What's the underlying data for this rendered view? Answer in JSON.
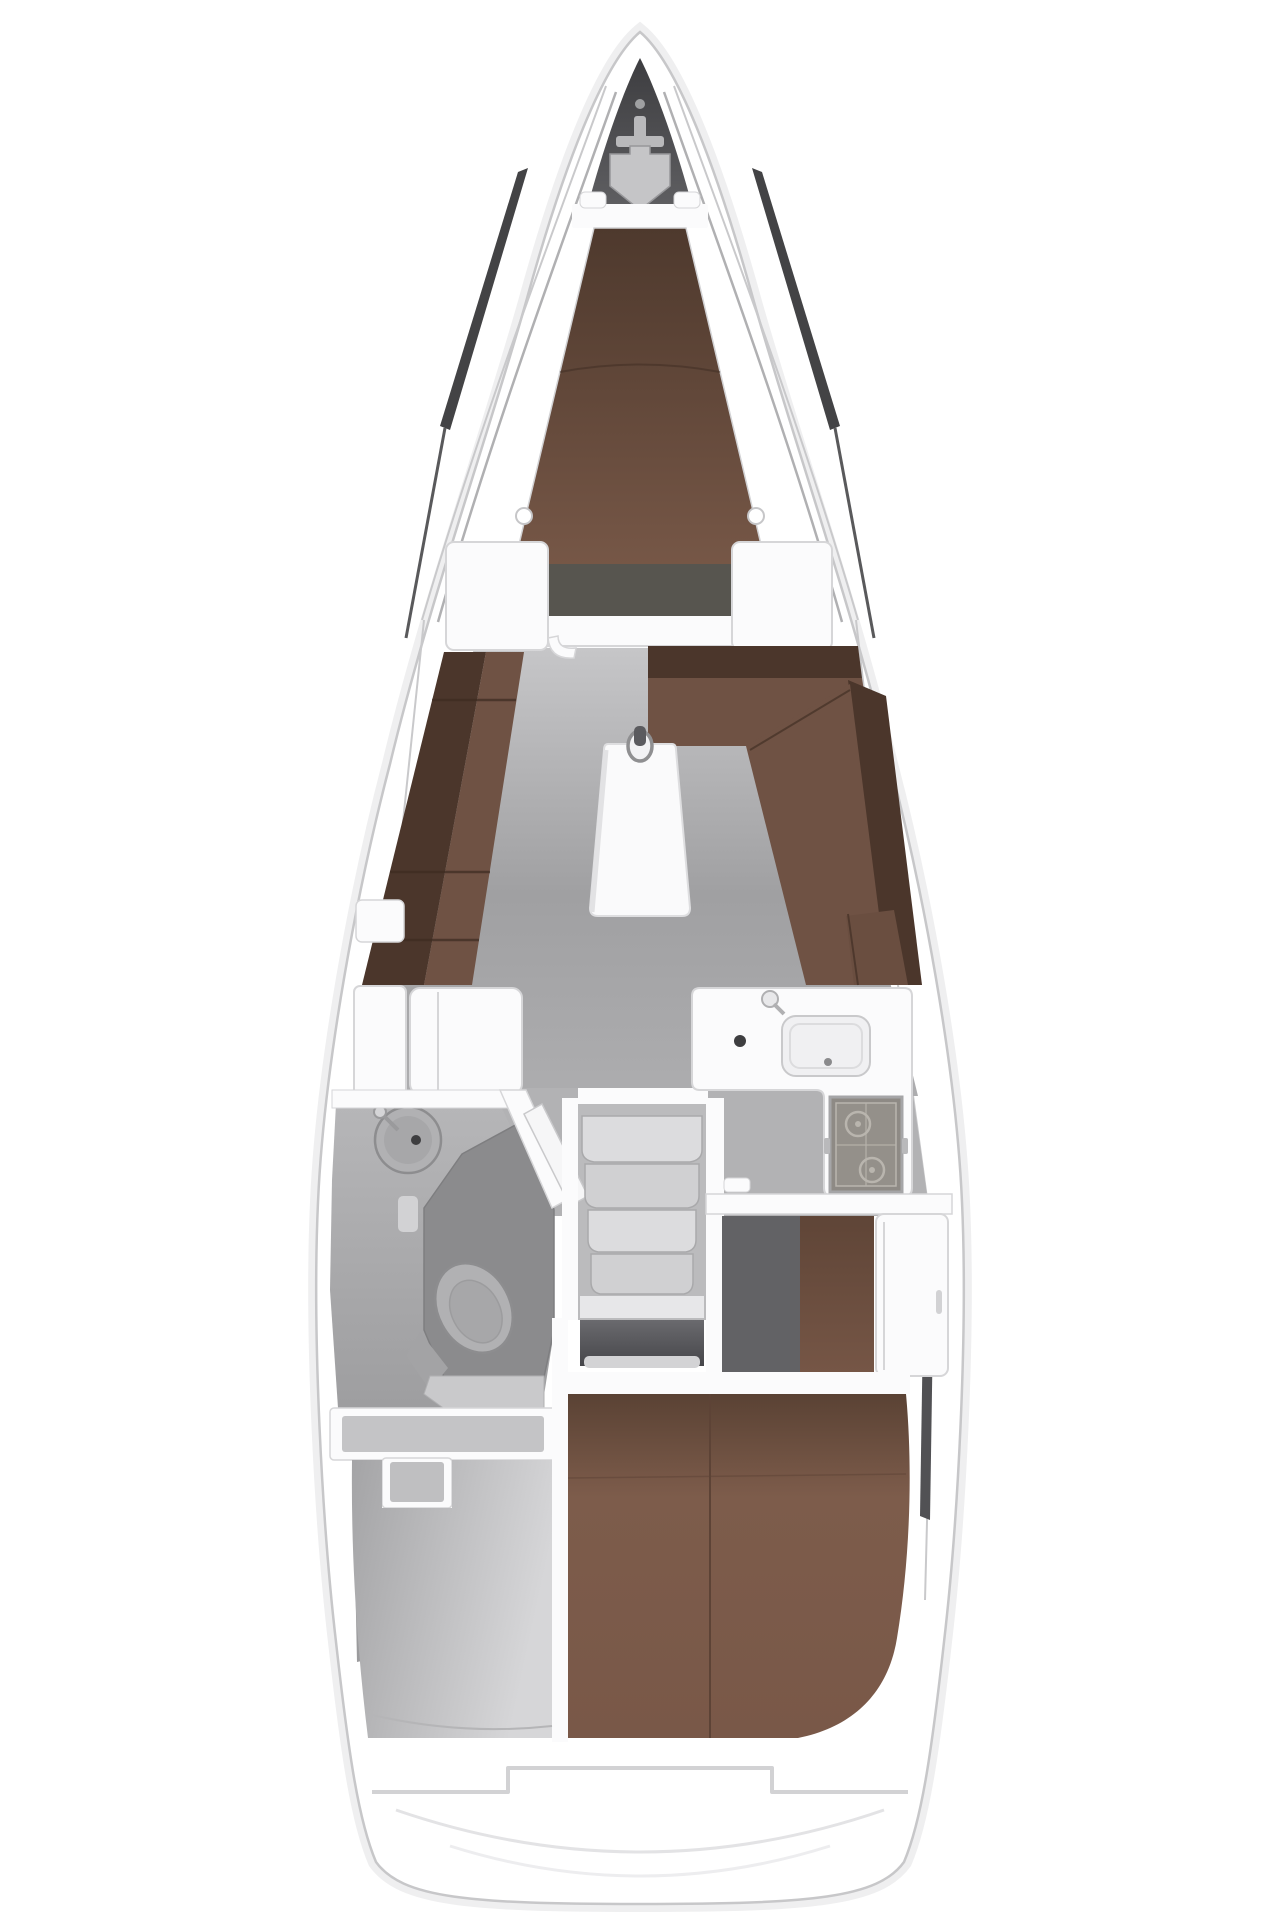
{
  "figure": {
    "type": "yacht-interior-floorplan",
    "orientation": "bow-up",
    "visible_text": ""
  },
  "regions": [
    {
      "id": "hull",
      "name": "hull-outline"
    },
    {
      "id": "anchor-locker",
      "name": "anchor-locker"
    },
    {
      "id": "v-berth",
      "name": "forward-cabin-v-berth"
    },
    {
      "id": "port-settee",
      "name": "saloon-port-settee"
    },
    {
      "id": "starboard-dinette",
      "name": "saloon-starboard-dinette"
    },
    {
      "id": "saloon-table",
      "name": "saloon-table"
    },
    {
      "id": "mast-post",
      "name": "mast-post"
    },
    {
      "id": "nav-cabinet",
      "name": "port-cabinet"
    },
    {
      "id": "head",
      "name": "head-bathroom"
    },
    {
      "id": "washbasin",
      "name": "head-washbasin"
    },
    {
      "id": "toilet",
      "name": "toilet"
    },
    {
      "id": "shower-seat",
      "name": "shower-seat"
    },
    {
      "id": "companionway",
      "name": "companionway-steps",
      "step_count": 4
    },
    {
      "id": "galley",
      "name": "galley"
    },
    {
      "id": "galley-sink",
      "name": "galley-sink"
    },
    {
      "id": "stove",
      "name": "two-burner-stove",
      "burner_count": 2
    },
    {
      "id": "wardrobe",
      "name": "aft-cabin-wardrobe"
    },
    {
      "id": "aft-berth",
      "name": "aft-cabin-double-berth"
    },
    {
      "id": "lazarette",
      "name": "port-aft-storage"
    },
    {
      "id": "transom",
      "name": "transom-swim-step"
    }
  ],
  "colors": {
    "page_bg": "#ffffff",
    "hull_fill": "#ffffff",
    "hull_halo": "#efeff0",
    "hull_line": "#c7c7c9",
    "deck_line": "#b0b0b2",
    "deck_line_outer": "#c9c9cb",
    "deck_line_dark": "#2f2f31",
    "deck_line_mid": "#59595b",
    "anchor_dark": "#47474a",
    "hatch_gray": "#c5c5c7",
    "fitting_gray": "#b9b9bb",
    "wall_white": "#fbfbfc",
    "panel_line": "#d6d6d8",
    "berth_foot": "#57554f",
    "settee_back": "#4b362b",
    "settee_seat": "#6f5244",
    "seam_brown": "#3d2b21",
    "corner_cushion": "#6a4e40",
    "table_white": "#fafafb",
    "table_shadow": "#e2e2e4",
    "mast_ring": "#8f8f91",
    "mast_slot": "#5b5b5f",
    "galley_floor": "#b2b2b4",
    "steps_floor": "#bbbbbd",
    "head_wall": "#f6f6f7",
    "shower_tray": "#8b8b8d",
    "fixture_fill": "#b1b1b3",
    "fixture_line": "#8d8d8f",
    "fixture_inner": "#a7a7a9",
    "fixture_base": "#a3a3a5",
    "drain_dark": "#3e3e40",
    "seat_gray": "#c9c9cb",
    "step_light": "#dcdcde",
    "step_mid": "#d0d0d2",
    "step_edge": "#a9a9ab",
    "landing_gray": "#e7e7e9",
    "lip_gray": "#d3d3d5",
    "aft_floor_dark": "#626265",
    "sink_inset": "#f0f0f2",
    "sink_line": "#c9c9cb",
    "stove_frame": "#a5a5a7",
    "stove_face": "#8e8a85",
    "stove_inner": "#94908a",
    "burner_line": "#b9b5ae",
    "laz_inner_gray": "#c4c4c6",
    "laz_tab_gray": "#bfbfc1",
    "sliver_gray": "#9b9b9d",
    "sliver_dark": "#515154",
    "transom_line": "#d2d2d4",
    "arc_line": "#e3e3e5",
    "arc_faint": "#ededef",
    "handle_gray": "#d2d2d4",
    "knob_gray": "#d5d5d7"
  }
}
